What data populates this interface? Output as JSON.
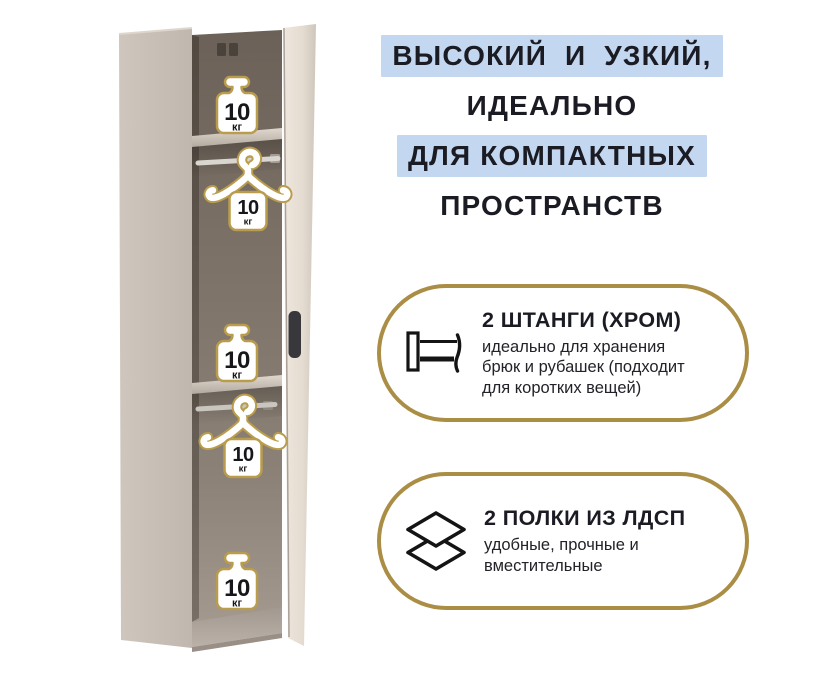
{
  "headline": {
    "text_color": "#1b1b24",
    "highlight_color": "#c3d8f0",
    "lines": [
      {
        "text": "ВЫСОКИЙ  И  УЗКИЙ,",
        "highlighted": true
      },
      {
        "text": "ИДЕАЛЬНО",
        "highlighted": false
      },
      {
        "text": "ДЛЯ КОМПАКТНЫХ",
        "highlighted": true
      },
      {
        "text": "ПРОСТРАНСТВ",
        "highlighted": false
      }
    ]
  },
  "wardrobe": {
    "badges": [
      {
        "type": "weight-badge",
        "value": "10",
        "unit": "кг"
      },
      {
        "type": "hanger-badge",
        "value": "10",
        "unit": "кг"
      },
      {
        "type": "weight-badge",
        "value": "10",
        "unit": "кг"
      },
      {
        "type": "hanger-badge",
        "value": "10",
        "unit": "кг"
      },
      {
        "type": "weight-badge",
        "value": "10",
        "unit": "кг"
      }
    ],
    "badge_outline_color": "#b99c4c"
  },
  "callouts": [
    {
      "icon": "clothes-rail-icon",
      "title": "2 ШТАНГИ (ХРОМ)",
      "body_lines": [
        "идеально для хранения",
        "брюк и рубашек (подходит",
        "для коротких вещей)"
      ]
    },
    {
      "icon": "shelves-layers-icon",
      "title": "2 ПОЛКИ ИЗ ЛДСП",
      "body_lines": [
        "удобные, прочные и",
        "вместительные"
      ]
    }
  ],
  "style": {
    "callout_border_color": "#ab8e45"
  }
}
